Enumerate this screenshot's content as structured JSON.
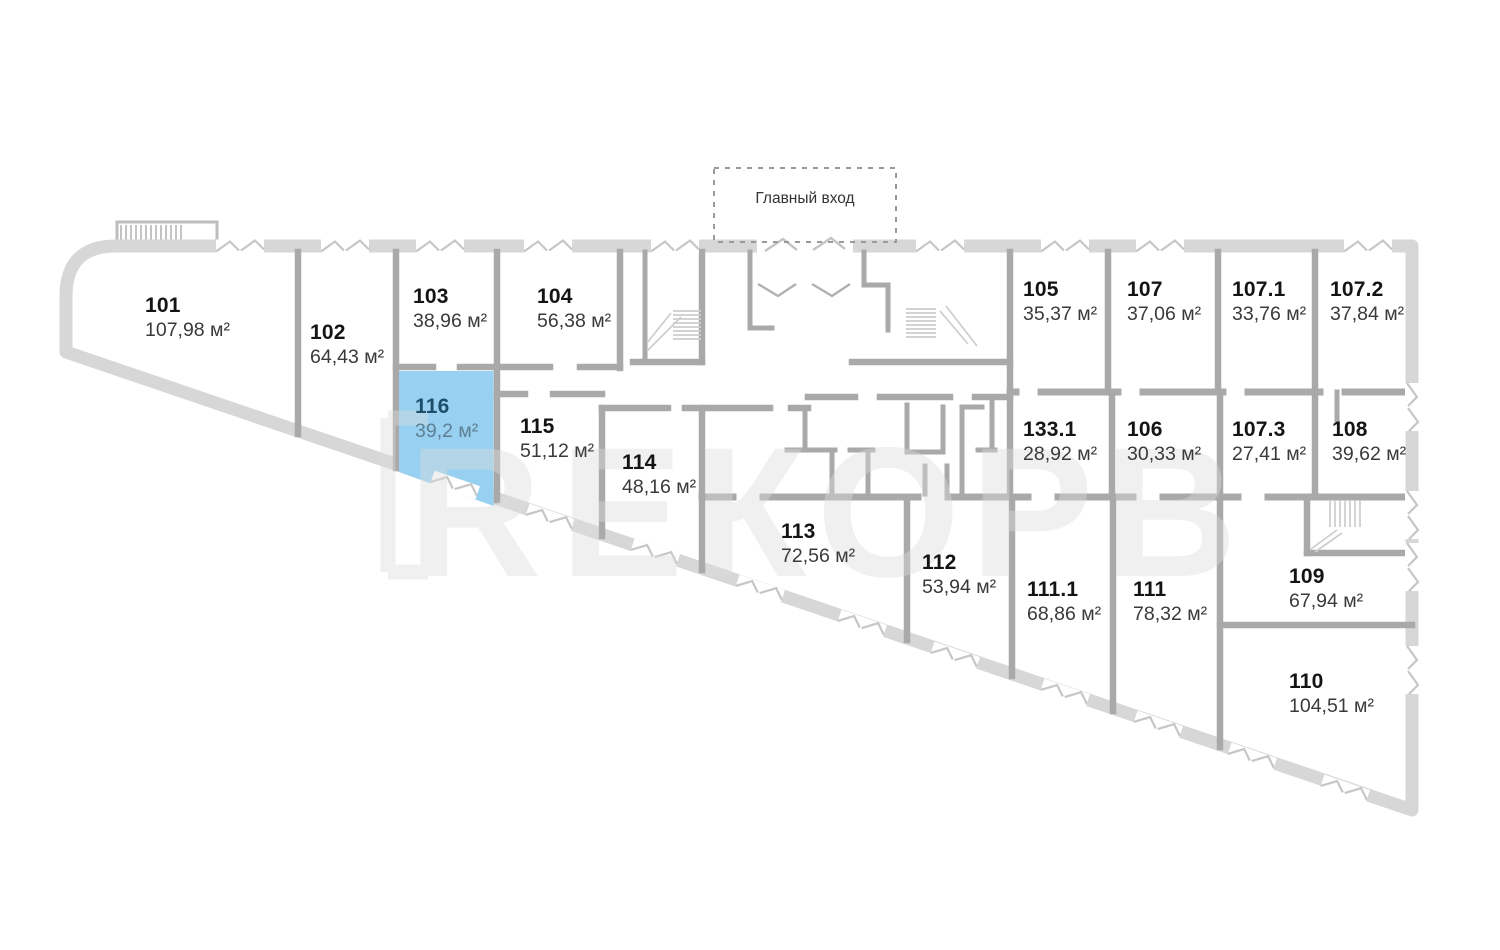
{
  "entrance": {
    "label": "Главный вход"
  },
  "watermark": {
    "logo_text": "R",
    "text": "ЕКОРВ"
  },
  "colors": {
    "highlight_fill": "#97d0f0",
    "highlight_number": "#1d4f6b",
    "highlight_area": "#5d8095",
    "unit_number": "#141414",
    "unit_area": "#3a3a3a",
    "outer_wall": "#d7d7d7",
    "inner_wall": "#a9a9a9",
    "watermark": "#dcdcdc"
  },
  "units": [
    {
      "id": "101",
      "area": "107,98 м²",
      "highlighted": false
    },
    {
      "id": "102",
      "area": "64,43 м²",
      "highlighted": false
    },
    {
      "id": "103",
      "area": "38,96 м²",
      "highlighted": false
    },
    {
      "id": "104",
      "area": "56,38 м²",
      "highlighted": false
    },
    {
      "id": "105",
      "area": "35,37 м²",
      "highlighted": false
    },
    {
      "id": "107",
      "area": "37,06 м²",
      "highlighted": false
    },
    {
      "id": "107.1",
      "area": "33,76 м²",
      "highlighted": false
    },
    {
      "id": "107.2",
      "area": "37,84 м²",
      "highlighted": false
    },
    {
      "id": "116",
      "area": "39,2 м²",
      "highlighted": true
    },
    {
      "id": "115",
      "area": "51,12 м²",
      "highlighted": false
    },
    {
      "id": "114",
      "area": "48,16 м²",
      "highlighted": false
    },
    {
      "id": "133.1",
      "area": "28,92 м²",
      "highlighted": false
    },
    {
      "id": "106",
      "area": "30,33 м²",
      "highlighted": false
    },
    {
      "id": "107.3",
      "area": "27,41 м²",
      "highlighted": false
    },
    {
      "id": "108",
      "area": "39,62 м²",
      "highlighted": false
    },
    {
      "id": "113",
      "area": "72,56 м²",
      "highlighted": false
    },
    {
      "id": "112",
      "area": "53,94 м²",
      "highlighted": false
    },
    {
      "id": "111.1",
      "area": "68,86 м²",
      "highlighted": false
    },
    {
      "id": "111",
      "area": "78,32 м²",
      "highlighted": false
    },
    {
      "id": "109",
      "area": "67,94 м²",
      "highlighted": false
    },
    {
      "id": "110",
      "area": "104,51 м²",
      "highlighted": false
    }
  ]
}
